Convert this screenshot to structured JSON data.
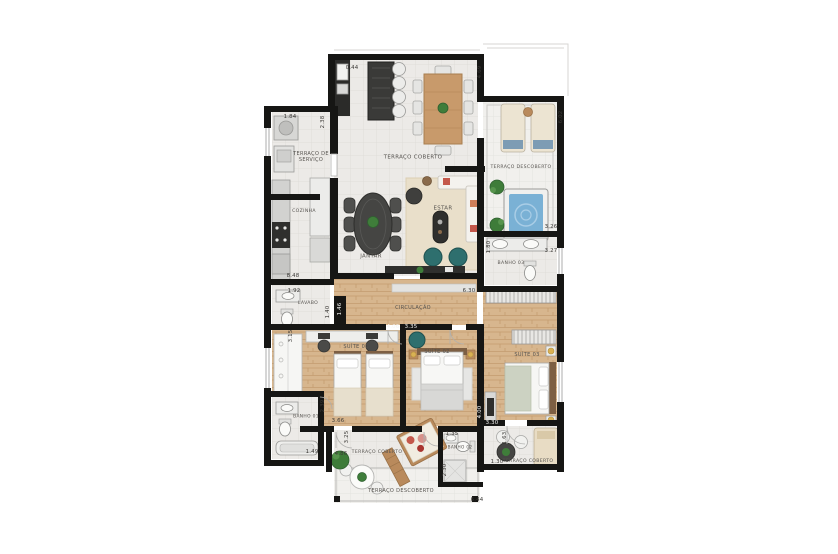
{
  "meta": {
    "type": "apartment-floor-plan",
    "language": "pt-BR"
  },
  "palette": {
    "background": "#ffffff",
    "wall": "#161614",
    "tile_floor": "#eceae7",
    "wood_floor": "#d7b68e",
    "accent_teal": "#2e6f6e",
    "pool_blue": "#7ab1d5",
    "plant_green": "#3f7d3a",
    "label_text": "#55524e"
  },
  "rooms": [
    {
      "id": "terraco-de-servico",
      "label": "TERRAÇO DE SERVIÇO",
      "x": 311,
      "y": 157,
      "w": 46,
      "fs": 5
    },
    {
      "id": "cozinha",
      "label": "COZINHA",
      "x": 304,
      "y": 212,
      "fs": 4.6
    },
    {
      "id": "terraco-coberto-superior",
      "label": "TERRAÇO COBERTO",
      "x": 413,
      "y": 158,
      "fs": 5.4
    },
    {
      "id": "terraco-descoberto-superior",
      "label": "TERRAÇO DESCOBERTO",
      "x": 521,
      "y": 168,
      "fs": 4.6
    },
    {
      "id": "estar",
      "label": "ESTAR",
      "x": 443,
      "y": 209,
      "fs": 5.4
    },
    {
      "id": "jantar",
      "label": "JANTAR",
      "x": 371,
      "y": 257,
      "fs": 5.4
    },
    {
      "id": "banho-03",
      "label": "BANHO 03",
      "x": 511,
      "y": 264,
      "fs": 4.6
    },
    {
      "id": "lavabo",
      "label": "LAVABO",
      "x": 308,
      "y": 304,
      "fs": 4.6
    },
    {
      "id": "circulacao",
      "label": "CIRCULAÇÃO",
      "x": 413,
      "y": 308,
      "fs": 5
    },
    {
      "id": "suite-01",
      "label": "SUÍTE 01",
      "x": 356,
      "y": 347,
      "fs": 5
    },
    {
      "id": "suite-02",
      "label": "SUÍTE 02",
      "x": 437,
      "y": 352,
      "fs": 5
    },
    {
      "id": "suite-03",
      "label": "SUÍTE 03",
      "x": 527,
      "y": 355,
      "fs": 5
    },
    {
      "id": "banho-01",
      "label": "BANHO 01",
      "x": 306,
      "y": 417,
      "fs": 4.4
    },
    {
      "id": "terraco-coberto-inferior",
      "label": "TERRAÇO COBERTO",
      "x": 377,
      "y": 453,
      "fs": 4.6
    },
    {
      "id": "banho-02",
      "label": "BANHO 02",
      "x": 460,
      "y": 447,
      "fs": 4.2
    },
    {
      "id": "terraco-coberto-direito",
      "label": "TERRAÇO COBERTO",
      "x": 528,
      "y": 462,
      "fs": 4.6
    },
    {
      "id": "terraco-descoberto-inferior",
      "label": "TERRAÇO DESCOBERTO",
      "x": 401,
      "y": 491,
      "fs": 5
    }
  ],
  "dimensions": [
    {
      "t": "0.44",
      "x": 352,
      "y": 68
    },
    {
      "t": "4.69",
      "x": 480,
      "y": 72,
      "v": 1
    },
    {
      "t": "6.02",
      "x": 561,
      "y": 117,
      "v": 1
    },
    {
      "t": "1.84",
      "x": 290,
      "y": 117
    },
    {
      "t": "2.38",
      "x": 323,
      "y": 122,
      "v": 1
    },
    {
      "t": "8.48",
      "x": 293,
      "y": 276
    },
    {
      "t": "1.92",
      "x": 294,
      "y": 291
    },
    {
      "t": "1.40",
      "x": 328,
      "y": 312,
      "v": 1
    },
    {
      "t": "1.46",
      "x": 340,
      "y": 309,
      "v": 1,
      "light": 1
    },
    {
      "t": "3.15",
      "x": 291,
      "y": 336,
      "v": 1
    },
    {
      "t": "6.30",
      "x": 469,
      "y": 291
    },
    {
      "t": "4.06",
      "x": 393,
      "y": 327,
      "light": 1
    },
    {
      "t": "3.35",
      "x": 411,
      "y": 327,
      "light": 1
    },
    {
      "t": "1.80",
      "x": 489,
      "y": 247,
      "v": 1
    },
    {
      "t": "3.26",
      "x": 551,
      "y": 227
    },
    {
      "t": "3.27",
      "x": 551,
      "y": 251
    },
    {
      "t": "2.39",
      "x": 323,
      "y": 406,
      "v": 1
    },
    {
      "t": "3.66",
      "x": 338,
      "y": 421
    },
    {
      "t": "1.49",
      "x": 312,
      "y": 452
    },
    {
      "t": "4.86",
      "x": 341,
      "y": 454
    },
    {
      "t": "3.25",
      "x": 347,
      "y": 437,
      "v": 1
    },
    {
      "t": "4.00",
      "x": 480,
      "y": 412,
      "v": 1,
      "light": 1
    },
    {
      "t": "3.30",
      "x": 492,
      "y": 423,
      "light": 1
    },
    {
      "t": "1.35",
      "x": 452,
      "y": 434
    },
    {
      "t": "2.30",
      "x": 445,
      "y": 470,
      "v": 1
    },
    {
      "t": "1.63",
      "x": 505,
      "y": 438,
      "v": 1
    },
    {
      "t": "1.30",
      "x": 497,
      "y": 462
    },
    {
      "t": "6.44",
      "x": 477,
      "y": 500
    }
  ]
}
